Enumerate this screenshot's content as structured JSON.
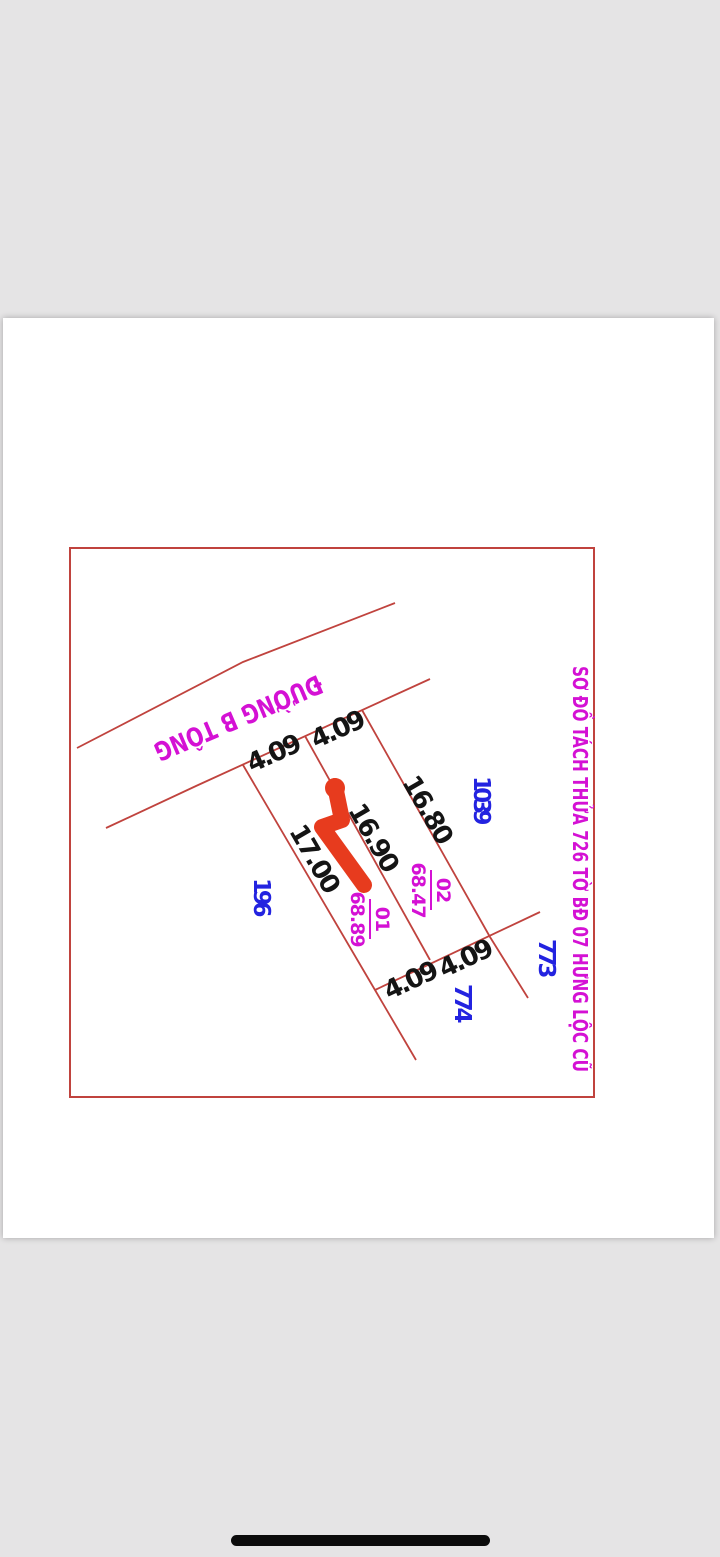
{
  "colors": {
    "screen-bg": "#e5e4e5",
    "sheet-bg": "#ffffff",
    "line-red": "#c0433e",
    "magenta": "#d411d4",
    "blue": "#2323e0",
    "black": "#141414",
    "scribble-red": "#e73b1e",
    "home-bar": "#0b0b0b"
  },
  "diagram": {
    "title_vertical": "SƠ ĐỒ TÁCH THỬA 726 TỜ BĐ 07  HƯNG LỘC CŨ",
    "road_label": "ĐƯỜNG B TÔNG",
    "dims": {
      "top_left": "4.09",
      "top_right": "4.09",
      "side_left": "17.00",
      "side_mid": "16.90",
      "side_right": "16.80",
      "bottom_left": "4.09",
      "bottom_right": "4.09"
    },
    "plots": [
      {
        "number": "01",
        "area": "68.89"
      },
      {
        "number": "02",
        "area": "68.47"
      }
    ],
    "neighbors": {
      "west": "196",
      "north_east": "1039",
      "east": "773",
      "south": "774"
    }
  }
}
